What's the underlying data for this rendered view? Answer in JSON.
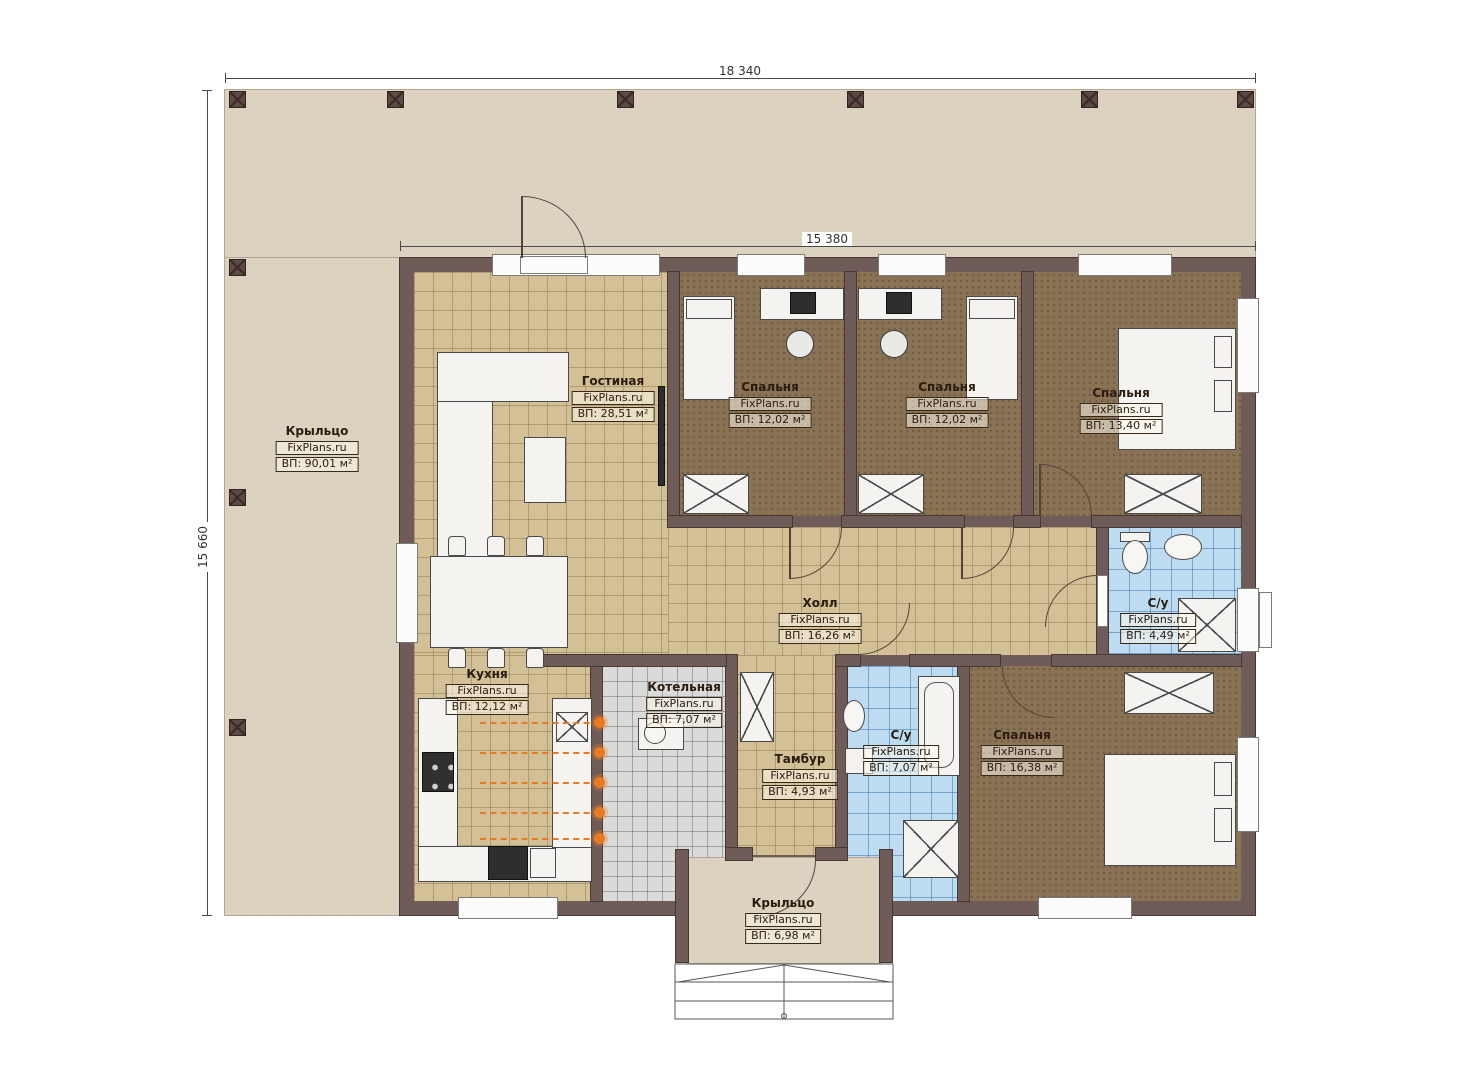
{
  "watermark": "FixPlans.ru",
  "dimensions": {
    "overall_width": "18 340",
    "house_width": "15 380",
    "overall_height": "15 660"
  },
  "rooms": [
    {
      "name": "Крыльцо",
      "area": "ВП: 90,01 м²"
    },
    {
      "name": "Гостиная",
      "area": "ВП: 28,51 м²"
    },
    {
      "name": "Спальня",
      "area": "ВП: 12,02 м²"
    },
    {
      "name": "Спальня",
      "area": "ВП: 12,02 м²"
    },
    {
      "name": "Спальня",
      "area": "ВП: 13,40 м²"
    },
    {
      "name": "Холл",
      "area": "ВП: 16,26 м²"
    },
    {
      "name": "С/у",
      "area": "ВП: 4,49 м²"
    },
    {
      "name": "Кухня",
      "area": "ВП: 12,12 м²"
    },
    {
      "name": "Котельная",
      "area": "ВП: 7,07 м²"
    },
    {
      "name": "Тамбур",
      "area": "ВП: 4,93 м²"
    },
    {
      "name": "С/у",
      "area": "ВП: 7,07 м²"
    },
    {
      "name": "Спальня",
      "area": "ВП: 16,38 м²"
    },
    {
      "name": "Крыльцо",
      "area": "ВП: 6,98 м²"
    }
  ]
}
